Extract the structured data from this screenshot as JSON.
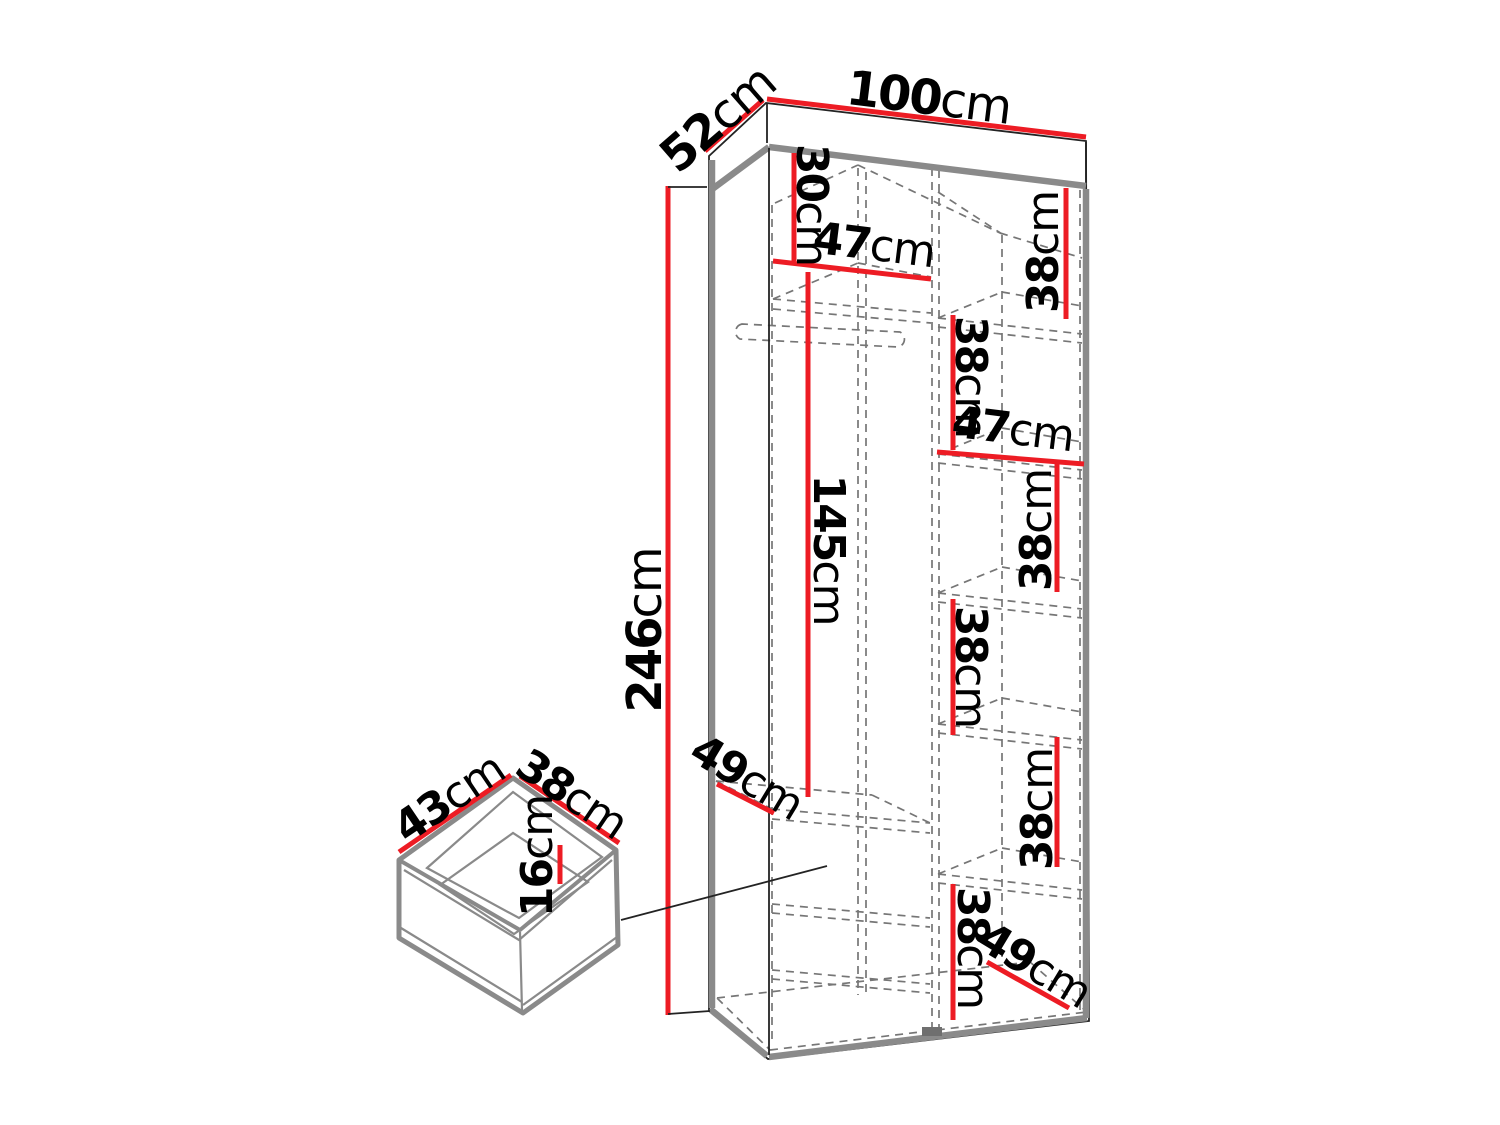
{
  "colors": {
    "dimension_red": "#ed1c24",
    "outline_gray": "#8a8a8a",
    "dashed_gray": "#767676",
    "line_black": "#232323",
    "label_black": "#000000",
    "background": "#ffffff"
  },
  "wardrobe": {
    "overall": {
      "width": {
        "value": "100",
        "unit": "cm"
      },
      "depth": {
        "value": "52",
        "unit": "cm"
      },
      "height": {
        "value": "246",
        "unit": "cm"
      }
    },
    "left_column": {
      "top_section_height": {
        "value": "30",
        "unit": "cm"
      },
      "interior_width": {
        "value": "47",
        "unit": "cm"
      },
      "hanging_section_height": {
        "value": "145",
        "unit": "cm"
      },
      "interior_depth": {
        "value": "49",
        "unit": "cm"
      }
    },
    "right_column": {
      "interior_width": {
        "value": "47",
        "unit": "cm"
      },
      "interior_depth": {
        "value": "49",
        "unit": "cm"
      },
      "shelf_section_heights": [
        {
          "value": "38",
          "unit": "cm"
        },
        {
          "value": "38",
          "unit": "cm"
        },
        {
          "value": "38",
          "unit": "cm"
        },
        {
          "value": "38",
          "unit": "cm"
        },
        {
          "value": "38",
          "unit": "cm"
        },
        {
          "value": "38",
          "unit": "cm"
        }
      ]
    }
  },
  "drawer": {
    "width": {
      "value": "43",
      "unit": "cm"
    },
    "depth": {
      "value": "38",
      "unit": "cm"
    },
    "height": {
      "value": "16",
      "unit": "cm"
    }
  }
}
